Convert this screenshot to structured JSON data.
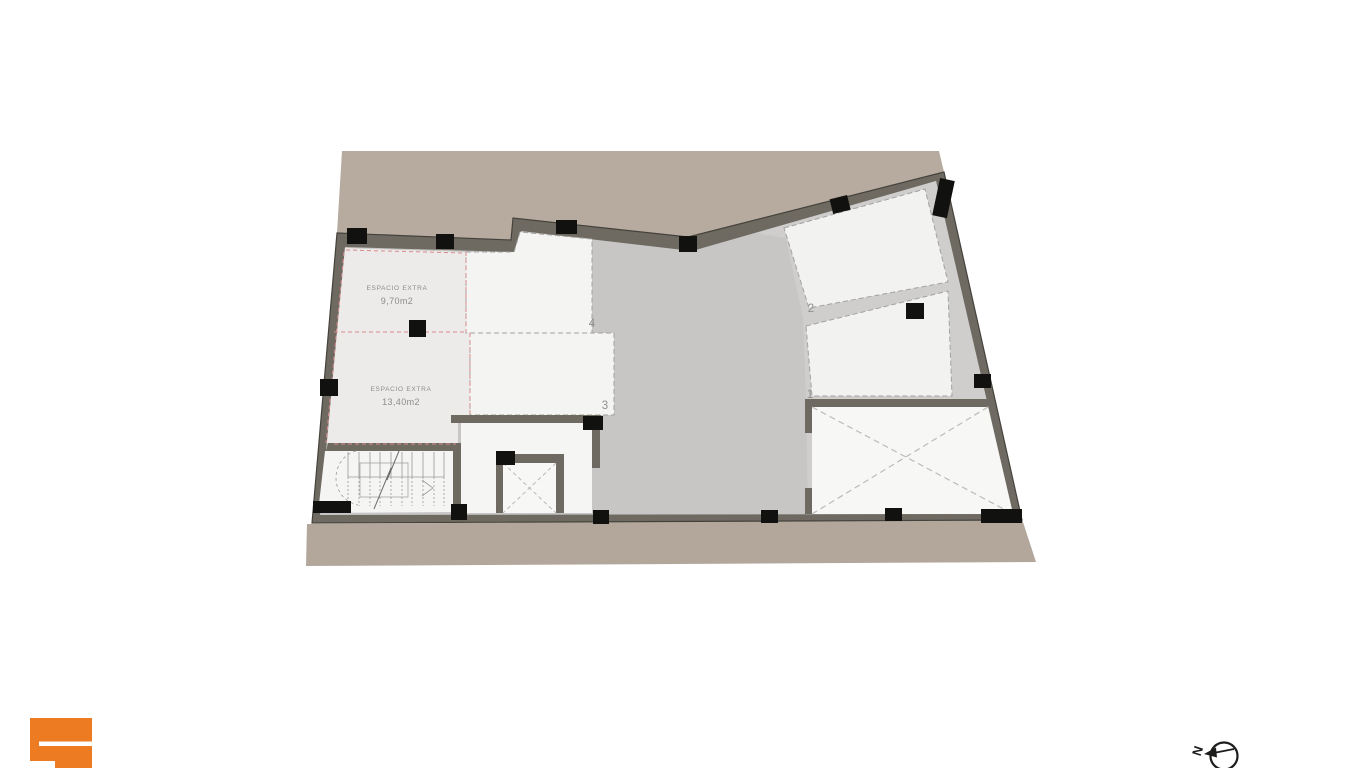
{
  "page": {
    "background_color": "#ffffff",
    "type_label": "architectural floor plan"
  },
  "floor_plan": {
    "colors": {
      "site_ground": "#b7aba0",
      "site_ground_bottom": "#b3a79c",
      "walls": "#6e6a62",
      "columns": "#111110",
      "floor_main": "#c7c6c5",
      "floor_right": "#cfcecd",
      "room_light": "#ecebe9",
      "room_white": "#f4f4f2",
      "red_dashed_line": "#d98b8b",
      "gray_dashed_line": "#a2a2a2"
    },
    "rooms": {
      "espacio_extra_1": {
        "label": "ESPACIO EXTRA",
        "area": "9,70m2"
      },
      "espacio_extra_2": {
        "label": "ESPACIO EXTRA",
        "area": "13,40m2"
      },
      "space_1": {
        "number": "1"
      },
      "space_2": {
        "number": "2"
      },
      "space_3": {
        "number": "3"
      },
      "space_4": {
        "number": "4"
      }
    },
    "icons": {
      "stair": "staircase-symbol",
      "shaft_small": "shaft-cross-symbol",
      "void_large": "void-cross-symbol"
    }
  },
  "branding": {
    "logo_icon": "orange-logo-mark",
    "logo_color": "#ed7b22"
  },
  "compass": {
    "icon": "north-arrow-icon",
    "north_label": "N"
  }
}
